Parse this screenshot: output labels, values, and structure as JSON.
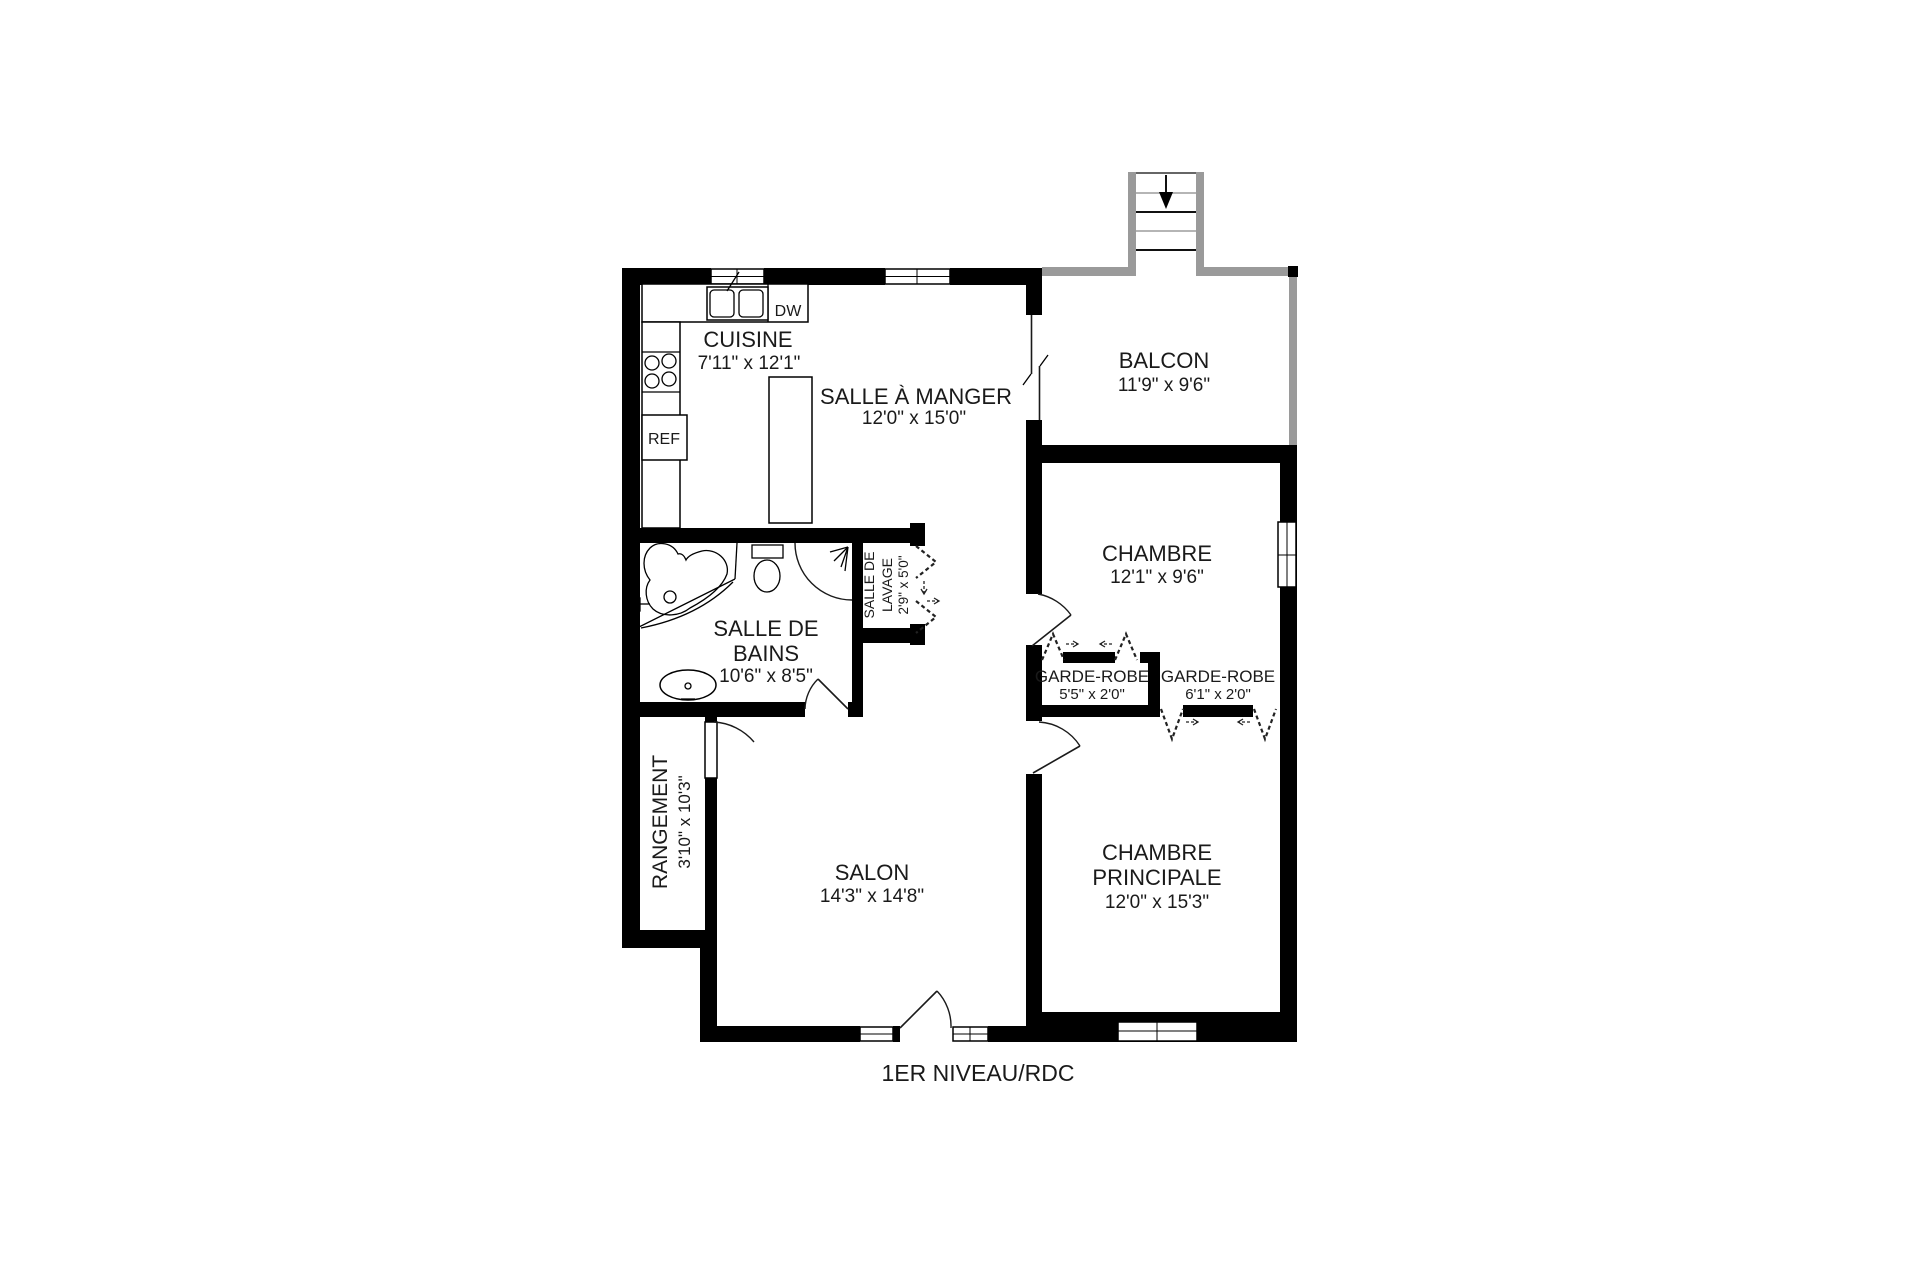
{
  "title": "1ER NIVEAU/RDC",
  "rooms": {
    "cuisine": {
      "name": "CUISINE",
      "dims": "7'11\" x 12'1\""
    },
    "salle_a_manger": {
      "name": "SALLE À MANGER",
      "dims": "12'0\" x 15'0\""
    },
    "balcon": {
      "name": "BALCON",
      "dims": "11'9\" x 9'6\""
    },
    "chambre": {
      "name": "CHAMBRE",
      "dims": "12'1\" x 9'6\""
    },
    "salle_de_bains": {
      "name_line1": "SALLE DE",
      "name_line2": "BAINS",
      "dims": "10'6\" x 8'5\""
    },
    "salle_de_lavage": {
      "name_line1": "SALLE DE",
      "name_line2": "LAVAGE",
      "dims": "2'9\" x 5'0\""
    },
    "garde_robe_gauche": {
      "name": "GARDE-ROBE",
      "dims": "5'5\" x 2'0\""
    },
    "garde_robe_droite": {
      "name": "GARDE-ROBE",
      "dims": "6'1\" x 2'0\""
    },
    "rangement": {
      "name": "RANGEMENT",
      "dims": "3'10\" x 10'3\""
    },
    "salon": {
      "name": "SALON",
      "dims": "14'3\" x 14'8\""
    },
    "chambre_principale": {
      "name_line1": "CHAMBRE",
      "name_line2": "PRINCIPALE",
      "dims": "12'0\" x 15'3\""
    }
  },
  "appliances": {
    "dishwasher": "DW",
    "refrigerator": "REF"
  },
  "colors": {
    "wall": "#000000",
    "porch_wall": "#9a9a9a",
    "background": "#ffffff"
  }
}
